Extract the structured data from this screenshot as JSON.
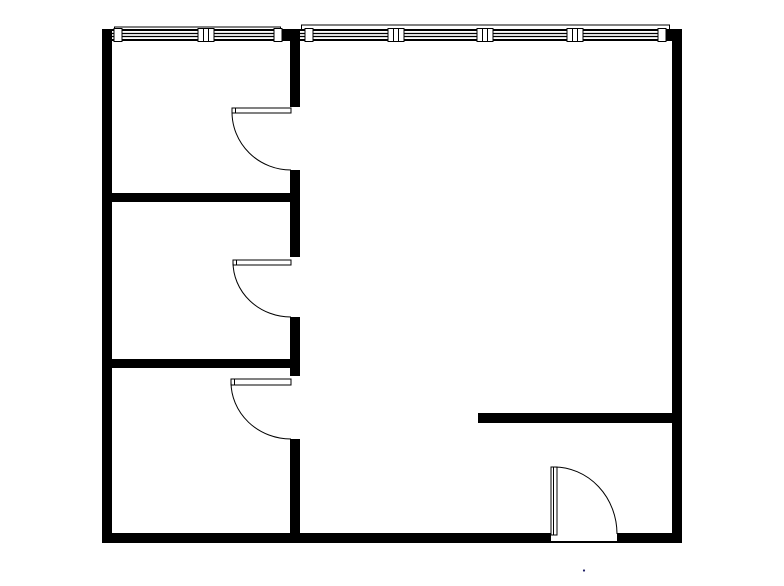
{
  "canvas": {
    "width": 784,
    "height": 586,
    "background_color": "#ffffff",
    "ink_color": "#000000"
  },
  "floor_plan": {
    "walls": [
      {
        "name": "wall-exterior-left",
        "x": 102,
        "y": 29,
        "w": 10,
        "h": 514
      },
      {
        "name": "wall-exterior-right",
        "x": 672,
        "y": 29,
        "w": 10,
        "h": 514
      },
      {
        "name": "wall-exterior-bottom-west",
        "x": 102,
        "y": 533,
        "w": 449,
        "h": 10
      },
      {
        "name": "wall-exterior-bottom-east",
        "x": 617,
        "y": 533,
        "w": 65,
        "h": 10
      },
      {
        "name": "wall-top-pier-center",
        "x": 281,
        "y": 29,
        "w": 19,
        "h": 12
      },
      {
        "name": "wall-top-corner-east",
        "x": 665,
        "y": 29,
        "w": 17,
        "h": 12
      },
      {
        "name": "wall-interior-vertical-a",
        "x": 290,
        "y": 41,
        "w": 10,
        "h": 66
      },
      {
        "name": "wall-interior-vertical-b",
        "x": 290,
        "y": 170,
        "w": 10,
        "h": 87
      },
      {
        "name": "wall-interior-vertical-c",
        "x": 290,
        "y": 317,
        "w": 10,
        "h": 59
      },
      {
        "name": "wall-interior-vertical-d",
        "x": 290,
        "y": 439,
        "w": 10,
        "h": 94
      },
      {
        "name": "wall-interior-horizontal-1",
        "x": 102,
        "y": 193,
        "w": 198,
        "h": 9
      },
      {
        "name": "wall-interior-horizontal-2",
        "x": 102,
        "y": 359,
        "w": 198,
        "h": 9
      },
      {
        "name": "wall-interior-stub-east",
        "x": 478,
        "y": 413,
        "w": 204,
        "h": 10
      }
    ],
    "threshold": {
      "name": "entrance-threshold",
      "x": 551,
      "y": 541,
      "w": 66,
      "h": 2
    },
    "windows": [
      {
        "name": "window-north-west",
        "band": {
          "x": 112,
          "y": 29,
          "w": 170,
          "h": 12
        },
        "border_h": 2,
        "glazing_y": [
          33.5,
          36.5
        ],
        "sill_path": "M 114.5 29.5 V 27 H 280.5 V 29.5",
        "posts": [
          {
            "x": 114,
            "w": 8
          },
          {
            "x": 274,
            "w": 8
          }
        ],
        "mullions": [
          {
            "x": 198,
            "w": 16
          }
        ]
      },
      {
        "name": "window-north-east",
        "band": {
          "x": 300,
          "y": 29,
          "w": 372,
          "h": 12
        },
        "border_h": 2,
        "glazing_y": [
          33.5,
          36.5
        ],
        "sill_path": "M 301.5 29.5 V 25 H 669.5 V 29.5",
        "posts": [
          {
            "x": 305,
            "w": 8
          },
          {
            "x": 658,
            "w": 8
          }
        ],
        "mullions": [
          {
            "x": 388,
            "w": 16
          },
          {
            "x": 477,
            "w": 16
          },
          {
            "x": 567,
            "w": 16
          }
        ]
      }
    ],
    "post_top": 28.5,
    "post_height": 13,
    "doors": [
      {
        "name": "door-room-upper-left",
        "leaf": {
          "x": 232,
          "y": 108,
          "w": 59,
          "h": 5
        },
        "tick_path": "M 235.5 108 V 113",
        "arc_path": "M 232 112 A 59 58 0 0 0 291 170"
      },
      {
        "name": "door-room-middle-left",
        "leaf": {
          "x": 233,
          "y": 260,
          "w": 58,
          "h": 5
        },
        "tick_path": "M 236.5 260 V 265",
        "arc_path": "M 233 262 A 58 55 0 0 0 291 317"
      },
      {
        "name": "door-room-lower-left",
        "leaf": {
          "x": 231,
          "y": 379,
          "w": 60,
          "h": 6
        },
        "tick_path": "M 234.5 379 V 385",
        "arc_path": "M 231 382 A 60 57 0 0 0 291 439"
      },
      {
        "name": "door-entrance",
        "leaf": {
          "x": 551,
          "y": 467,
          "w": 6,
          "h": 68
        },
        "tick_path": "M 553.5 467 V 535",
        "arc_path": "M 554 467 A 63 67 0 0 1 617 534"
      }
    ],
    "dot": {
      "name": "stray-dot",
      "x": 584,
      "y": 570.5,
      "r": 1.1,
      "color": "#1f1f66"
    }
  }
}
